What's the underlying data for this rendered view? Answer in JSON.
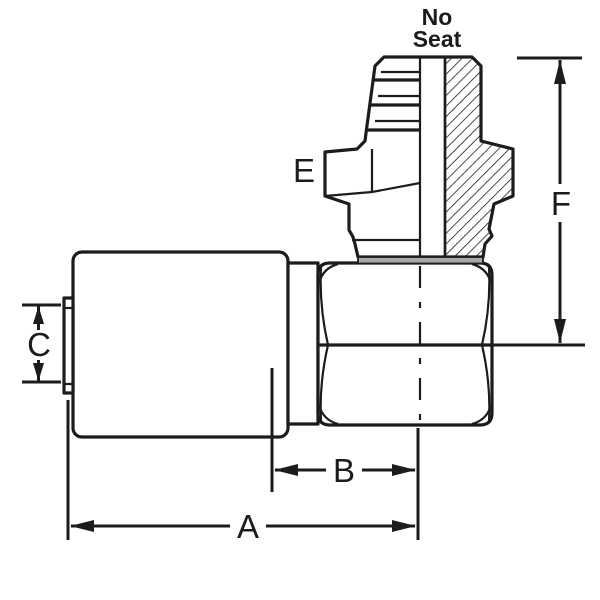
{
  "diagram": {
    "annotation": {
      "line1": "No",
      "line2": "Seat"
    },
    "labels": {
      "dim_a": "A",
      "dim_b": "B",
      "dim_c": "C",
      "dim_e": "E",
      "dim_f": "F"
    },
    "colors": {
      "line": "#1c1c1c",
      "washer_fill": "#a8a8a8",
      "background": "#ffffff",
      "annotation_bg": "#f6f6f6"
    }
  }
}
